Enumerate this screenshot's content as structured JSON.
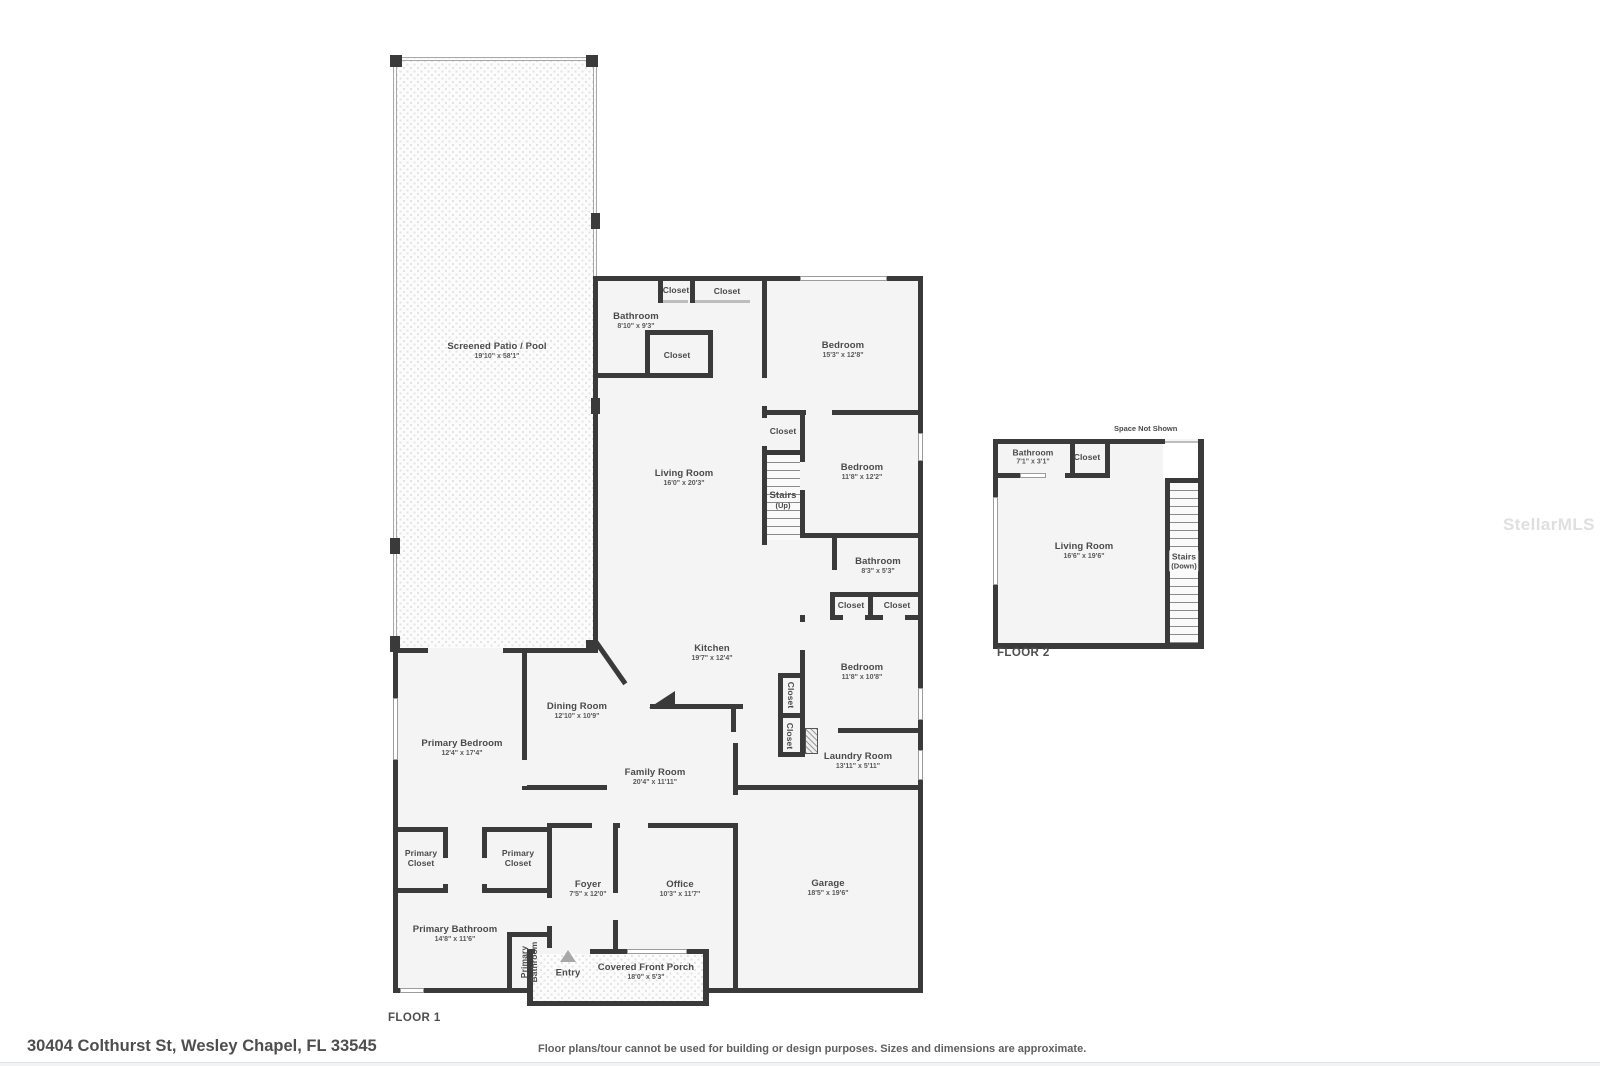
{
  "meta": {
    "watermark": "StellarMLS"
  },
  "footer": {
    "address": "30404 Colthurst St, Wesley Chapel, FL 33545",
    "disclaimer": "Floor plans/tour cannot be used for building or design purposes. Sizes and dimensions are approximate."
  },
  "floor1": {
    "label": "FLOOR 1",
    "rooms": {
      "patio": {
        "name": "Screened Patio / Pool",
        "dims": "19'10\" x 58'1\""
      },
      "bathroom_top": {
        "name": "Bathroom",
        "dims": "8'10\" x 9'3\""
      },
      "closet_top_1": {
        "name": "Closet"
      },
      "closet_top_2": {
        "name": "Closet"
      },
      "closet_mid": {
        "name": "Closet"
      },
      "bedroom_1": {
        "name": "Bedroom",
        "dims": "15'3\" x 12'8\""
      },
      "closet_stairs": {
        "name": "Closet"
      },
      "stairs_up": {
        "name": "Stairs",
        "sub": "(Up)"
      },
      "living_room": {
        "name": "Living Room",
        "dims": "16'0\" x 20'3\""
      },
      "bedroom_2": {
        "name": "Bedroom",
        "dims": "11'8\" x 12'2\""
      },
      "bathroom_2": {
        "name": "Bathroom",
        "dims": "8'3\" x 5'3\""
      },
      "closet_hall_1": {
        "name": "Closet"
      },
      "closet_hall_2": {
        "name": "Closet"
      },
      "kitchen": {
        "name": "Kitchen",
        "dims": "19'7\" x 12'4\""
      },
      "bedroom_3": {
        "name": "Bedroom",
        "dims": "11'8\" x 10'8\""
      },
      "closet_v1": {
        "name": "Closet"
      },
      "closet_v2": {
        "name": "Closet"
      },
      "laundry": {
        "name": "Laundry Room",
        "dims": "13'11\" x 5'11\""
      },
      "dining": {
        "name": "Dining Room",
        "dims": "12'10\" x 10'9\""
      },
      "primary_bedroom": {
        "name": "Primary Bedroom",
        "dims": "12'4\" x 17'4\""
      },
      "family": {
        "name": "Family Room",
        "dims": "20'4\" x 11'11\""
      },
      "primary_closet_1": {
        "name": "Primary Closet"
      },
      "primary_closet_2": {
        "name": "Primary Closet"
      },
      "foyer": {
        "name": "Foyer",
        "dims": "7'5\" x 12'0\""
      },
      "office": {
        "name": "Office",
        "dims": "10'3\" x 11'7\""
      },
      "garage": {
        "name": "Garage",
        "dims": "18'5\" x 19'6\""
      },
      "primary_bathroom": {
        "name": "Primary Bathroom",
        "dims": "14'8\" x 11'6\""
      },
      "primary_bathroom_v": {
        "name": "Primary Bathroom"
      },
      "entry": {
        "name": "Entry"
      },
      "porch": {
        "name": "Covered Front Porch",
        "dims": "18'0\" x 5'3\""
      }
    }
  },
  "floor2": {
    "label": "FLOOR 2",
    "note": "Space Not Shown",
    "rooms": {
      "bathroom": {
        "name": "Bathroom",
        "dims": "7'1\" x 3'1\""
      },
      "closet": {
        "name": "Closet"
      },
      "living_room": {
        "name": "Living Room",
        "dims": "16'6\" x 19'6\""
      },
      "stairs_down": {
        "name": "Stairs",
        "sub": "(Down)"
      }
    }
  }
}
